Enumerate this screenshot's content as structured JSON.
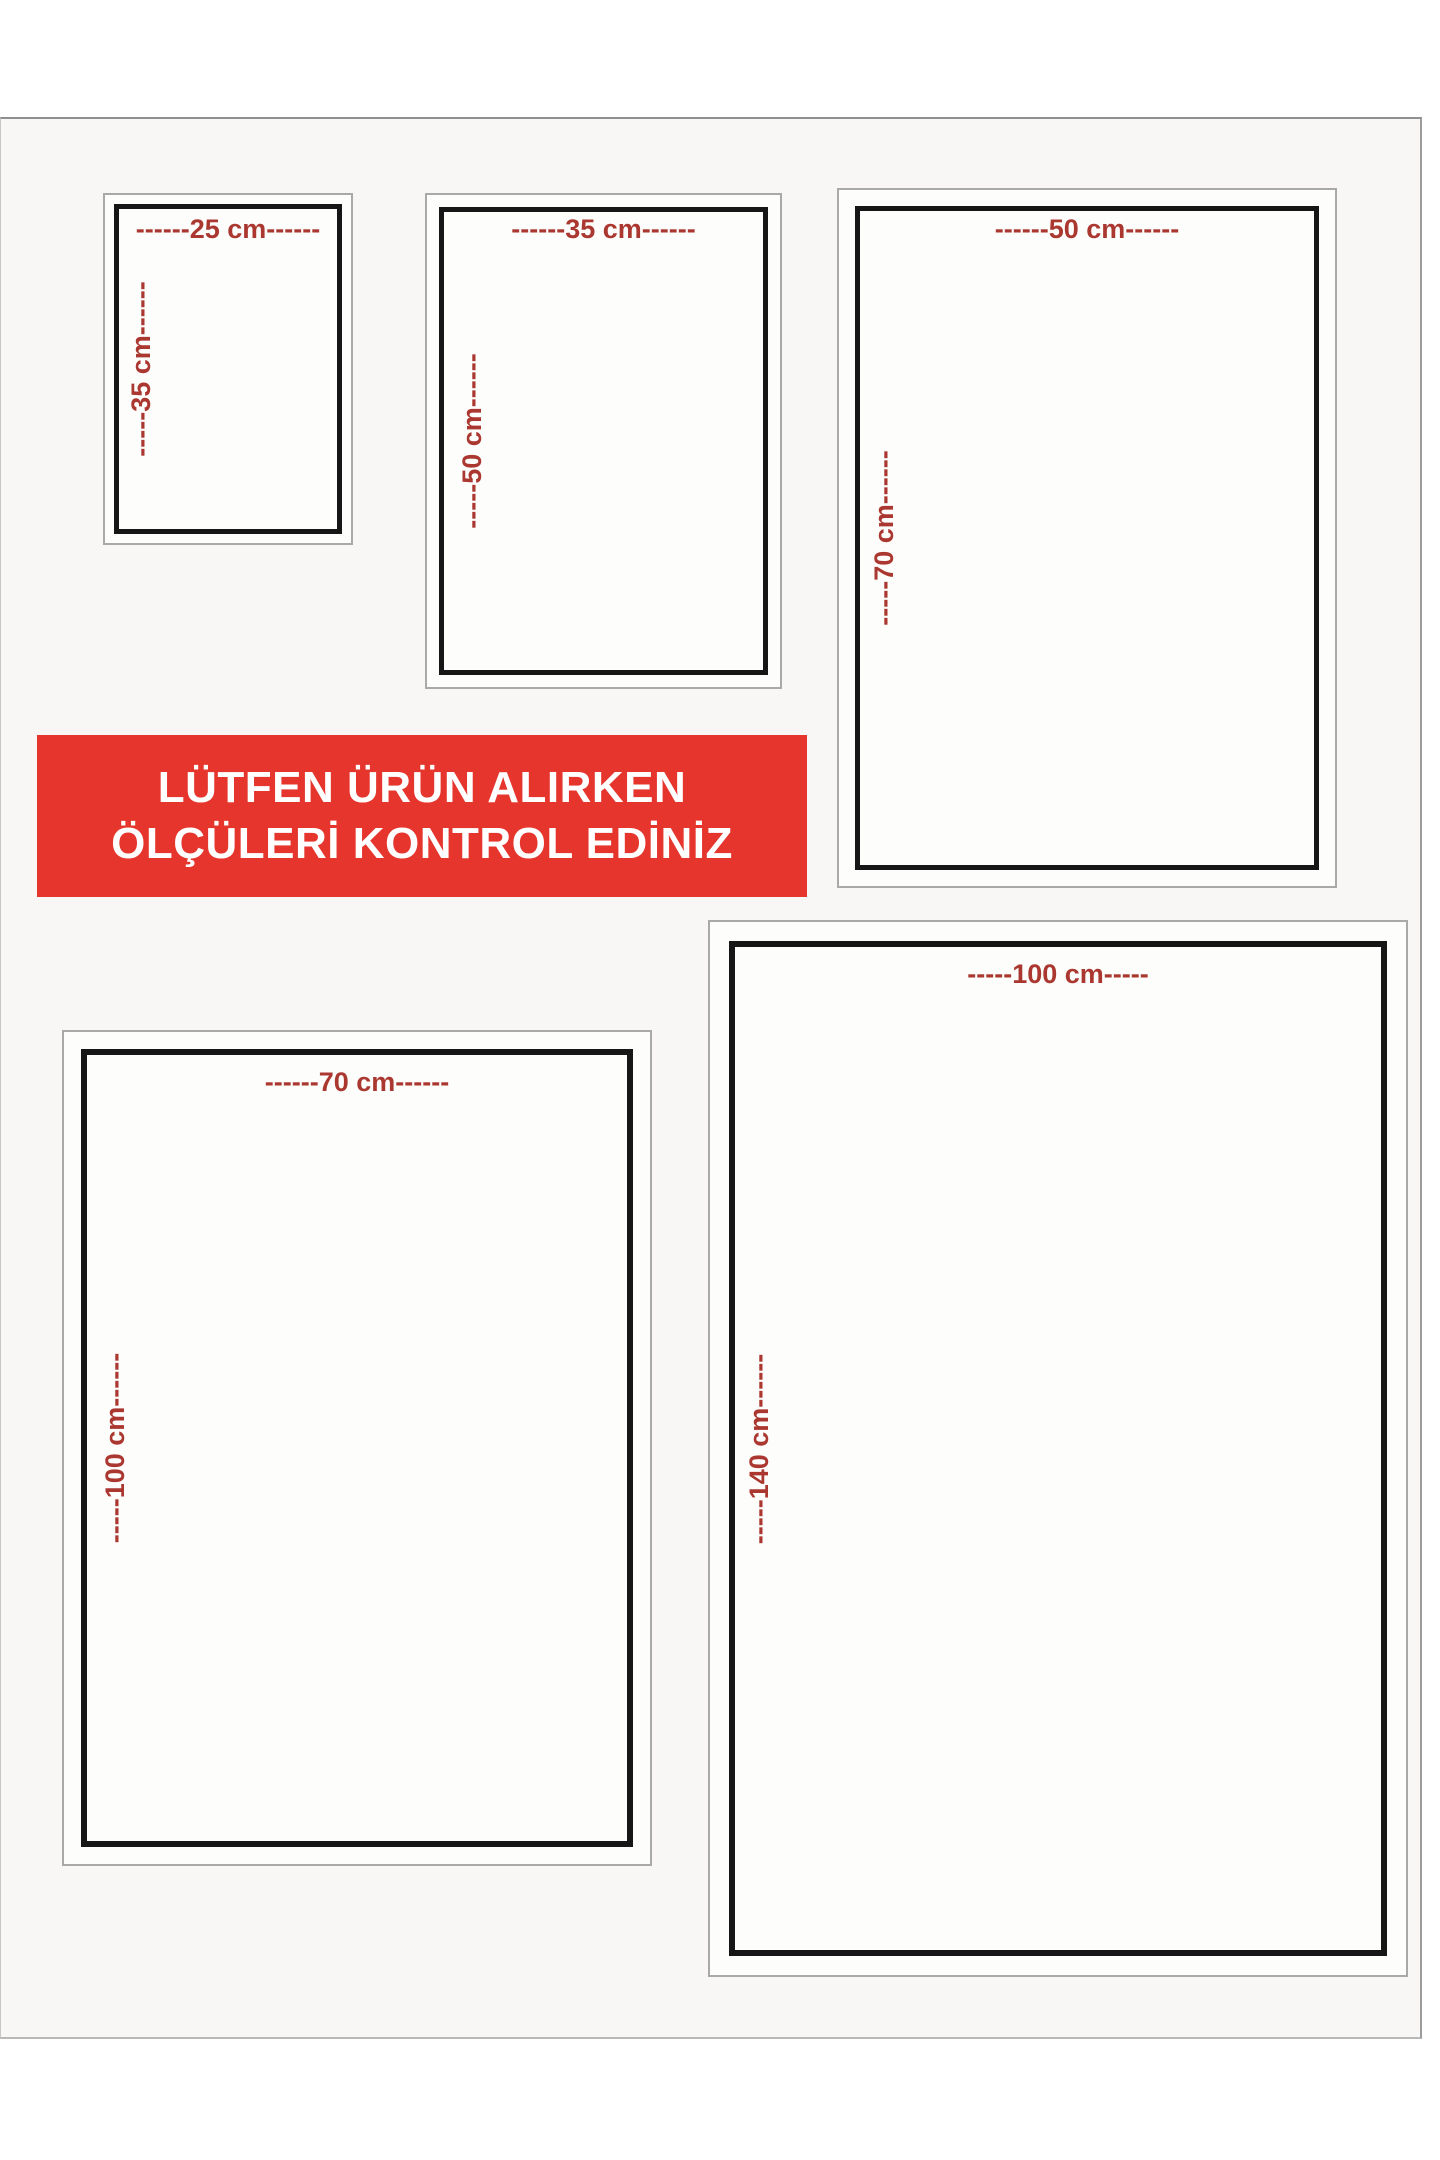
{
  "banner": {
    "line1": "LÜTFEN ÜRÜN ALIRKEN",
    "line2": "ÖLÇÜLERİ KONTROL EDİNİZ"
  },
  "colors": {
    "banner_bg": "#e5352c",
    "banner_text": "#ffffff",
    "label": "#ab3830",
    "frame": "#161616",
    "outline": "#a9a9a9",
    "board_bg": "#f8f7f5",
    "page_bg": "#ffffff"
  },
  "boxes": [
    {
      "size": "25x35 cm",
      "width_label": "------25 cm------",
      "height_label": "-----35 cm------"
    },
    {
      "size": "35x50 cm",
      "width_label": "------35 cm------",
      "height_label": "-----50 cm------"
    },
    {
      "size": "50x70 cm",
      "width_label": "------50 cm------",
      "height_label": "-----70 cm------"
    },
    {
      "size": "70x100 cm",
      "width_label": "------70 cm------",
      "height_label": "-----100 cm------"
    },
    {
      "size": "100x140 cm",
      "width_label": "-----100 cm-----",
      "height_label": "-----140 cm------"
    }
  ]
}
